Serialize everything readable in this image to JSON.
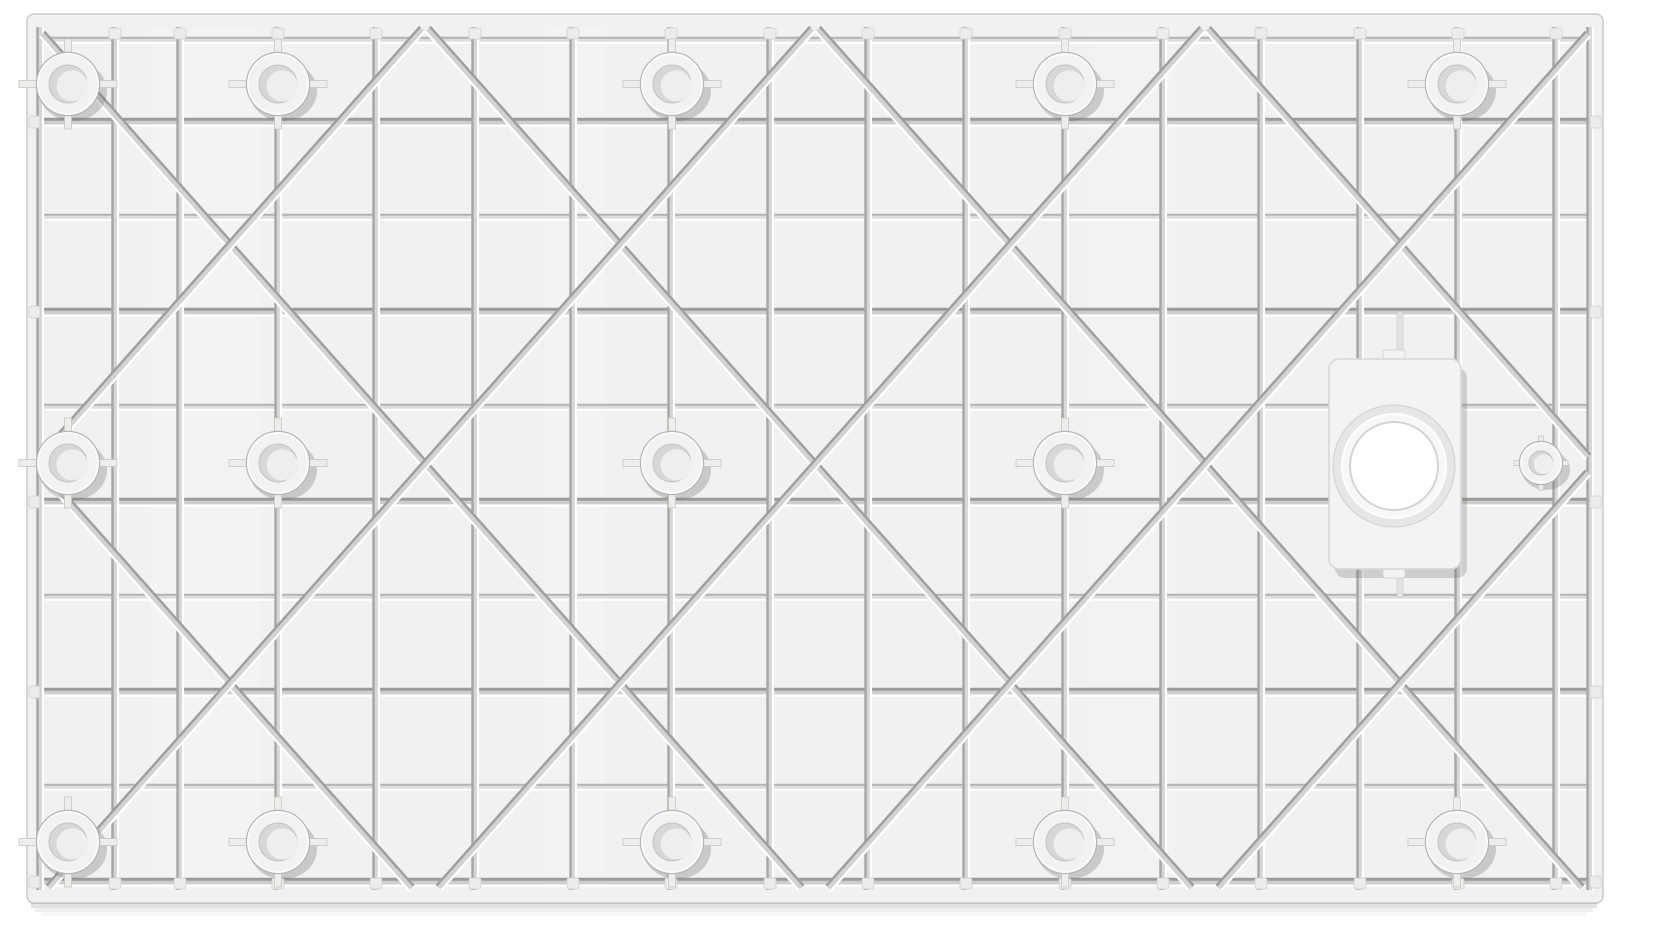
{
  "scene": {
    "type": "product-photograph",
    "subject": "Underside of a rectangular molded shower tray base",
    "caption": "White molded shower tray underside with reinforcement rib grid, diagonal braces, mounting bosses and drain opening",
    "background_color": "#ffffff"
  },
  "colors": {
    "panel_base": "#f1f1f0",
    "panel_edge": "#cbcbc9",
    "sheen": "#ffffff",
    "bottom_shadow": "rgba(100,100,98,0.18)"
  },
  "panel": {
    "x": 27,
    "y": 14,
    "width": 1576,
    "height": 889,
    "corner_radius": 7,
    "inner_x": 40,
    "inner_y": 27,
    "inner_x2": 1590,
    "inner_y2": 890
  },
  "grid": {
    "vertical_ribs": [
      40,
      115,
      180,
      278,
      376,
      475,
      573,
      671,
      770,
      868,
      966,
      1065,
      1163,
      1261,
      1360,
      1458,
      1556,
      1590
    ],
    "horizontal_ribs": [
      40,
      122,
      217,
      312,
      407,
      502,
      597,
      692,
      787,
      882
    ],
    "deep_horizontal_ribs": [
      122,
      312,
      502,
      692,
      882
    ],
    "groove_vertical": {
      "channel": "#d6d6d4",
      "channel_w": 7,
      "shadow": "#a6a6a4",
      "shadow_w": 2.4,
      "shadow_off": -2.5,
      "light": "#ffffff",
      "light_w": 2.2,
      "light_off": 3
    },
    "groove_h_deep": {
      "channel": "#cdcdcb",
      "channel_w": 8,
      "shadow": "#9b9b99",
      "shadow_w": 3,
      "shadow_off": -2.8,
      "light": "#ffffff",
      "light_w": 2.4,
      "light_off": 3.6
    },
    "groove_h_shallow": {
      "channel": "#dddddb",
      "channel_w": 6,
      "shadow": "#b3b3b1",
      "shadow_w": 2,
      "shadow_off": -2.2,
      "light": "#ffffff",
      "light_w": 2,
      "light_off": 2.8
    }
  },
  "diagonals": {
    "slope": 1.125,
    "top_y": 26,
    "backslash_x0": [
      -355,
      35,
      425,
      815,
      1205,
      1595
    ],
    "slash_x0": [
      35,
      425,
      815,
      1205,
      1595,
      1985
    ],
    "style": {
      "channel": "#d2d2d0",
      "channel_w": 7,
      "shadow": "#9e9e9c",
      "shadow_w": 2.4,
      "light": "#ffffff",
      "light_w": 2.2,
      "off": 2.3
    }
  },
  "bosses": {
    "row_y": [
      84,
      463,
      842
    ],
    "col_x": [
      68,
      278,
      672,
      1065,
      1457
    ],
    "skip_row_col": [
      [
        1,
        4
      ]
    ],
    "outer_radius": 30,
    "hole_radius": 19,
    "arm_half_x": 49,
    "arm_half_y": 45,
    "arm_width": 7,
    "colors": {
      "shadow": "rgba(110,110,108,0.30)",
      "arm_fill": "#ededeb",
      "arm_stroke": "#c6c6c4",
      "ring_outline": "#b5b5b3",
      "face": "#f2f2f1",
      "face_light": "#fafaf9",
      "hole": "#d7d7d5",
      "hole_stroke": "#c2c2c0",
      "crescent": "#eeeeec"
    }
  },
  "corner_small_boss": {
    "cx": 1541,
    "cy": 463,
    "outer_radius": 20,
    "hole_radius": 12,
    "arm_half": 27,
    "arm_width": 5
  },
  "drain": {
    "plate_x": 1329,
    "plate_y": 359,
    "plate_width": 132,
    "plate_height": 210,
    "plate_radius": 10,
    "cx": 1394,
    "cy": 466,
    "recess_radius": 61,
    "collar_radius": 52,
    "hole_radius": 44,
    "notch_width": 22,
    "notch_height": 12,
    "stub_x": 1400,
    "stub_top_y": 312,
    "stub_bottom_y": 597,
    "colors": {
      "shadow": "rgba(110,110,108,0.28)",
      "plate": "#f3f3f2",
      "plate_stroke": "#d5d5d3",
      "recess": "#e6e6e4",
      "recess_stroke": "#cfcfcd",
      "collar": "#f7f7f6",
      "collar_stroke": "#fdfdfc",
      "hole_fill": "#ffffff",
      "hole_stroke": "#d4d4d2"
    }
  },
  "rim_tabs": {
    "width": 12,
    "height": 11,
    "fill": "#ececea",
    "stroke": "#cdcdcb"
  },
  "sheen_bands": [
    {
      "x": 150,
      "w": 110,
      "opacity": 0.2
    },
    {
      "x": 545,
      "w": 60,
      "opacity": 0.14
    },
    {
      "x": 1090,
      "w": 85,
      "opacity": 0.11
    }
  ]
}
